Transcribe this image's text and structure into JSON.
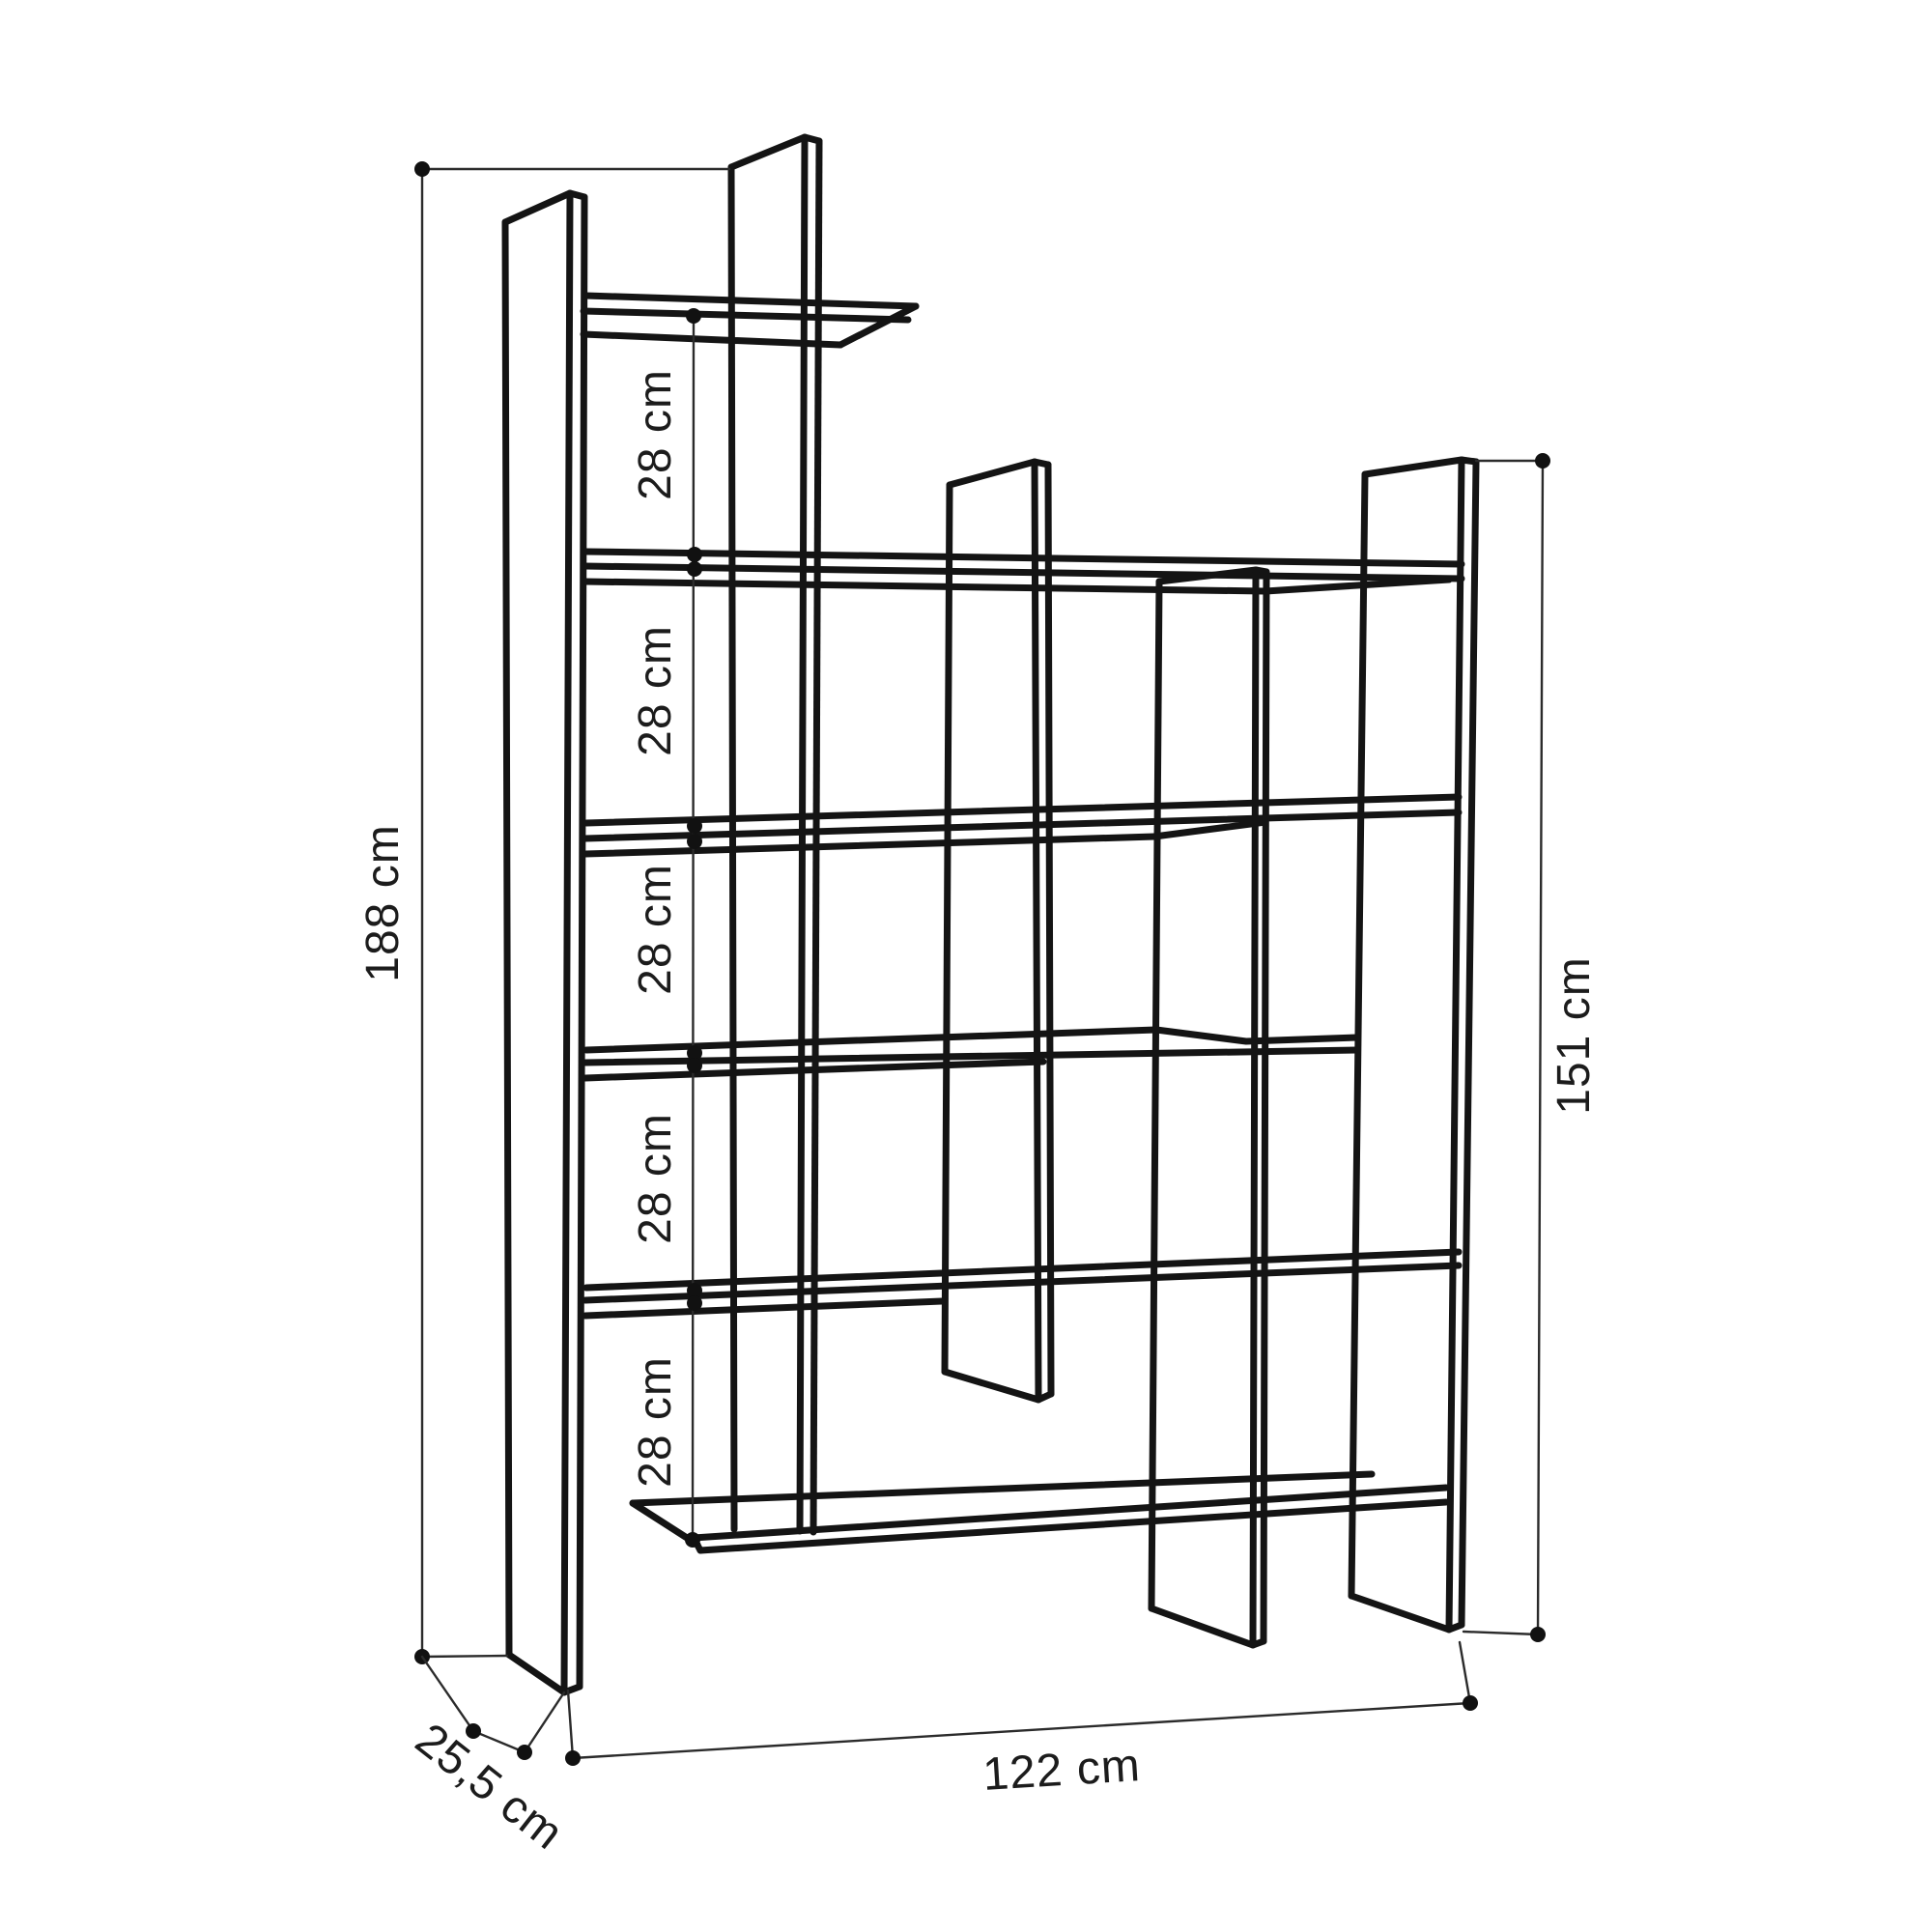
{
  "diagram": {
    "title": "bookshelf-dimension-drawing",
    "units": "cm",
    "colors": {
      "background": "#ffffff",
      "structure_line": "#141414",
      "dimension_line": "#2b2b2b",
      "text": "#1c1c1c"
    },
    "dimensions": {
      "total_height": {
        "text": "188 cm",
        "value": 188
      },
      "right_height": {
        "text": "151 cm",
        "value": 151
      },
      "width": {
        "text": "122 cm",
        "value": 122
      },
      "depth": {
        "text": "25,5 cm",
        "value": 25.5
      },
      "shelf_spacings": [
        {
          "text": "28 cm",
          "value": 28
        },
        {
          "text": "28 cm",
          "value": 28
        },
        {
          "text": "28 cm",
          "value": 28
        },
        {
          "text": "28 cm",
          "value": 28
        },
        {
          "text": "28 cm",
          "value": 28
        }
      ]
    }
  }
}
